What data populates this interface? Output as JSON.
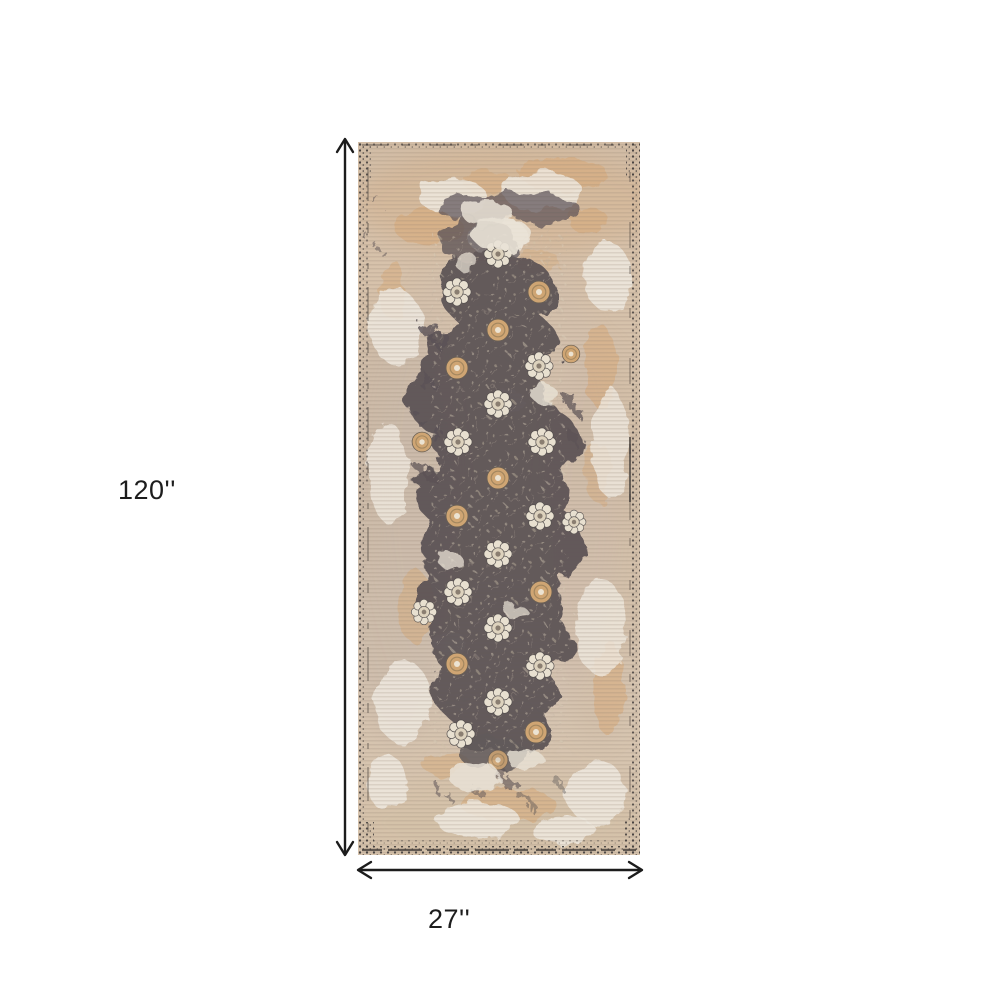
{
  "colors": {
    "page_bg": "#ffffff",
    "arrow": "#1c1c1c",
    "label": "#1d1d1d",
    "field_beige": "#d5c1ab",
    "field_light": "#efe9df",
    "accent_tan": "#d8a876",
    "panel_charcoal": "#5b5355",
    "rosette_cream": "#e8e0d0",
    "rosette_tan": "#cfa573",
    "edge_dark": "#46413f"
  },
  "dimensions": {
    "height_label": "120''",
    "width_label": "27''"
  },
  "product_image": {
    "description": "Distressed beige and charcoal vintage oriental runner rug"
  }
}
